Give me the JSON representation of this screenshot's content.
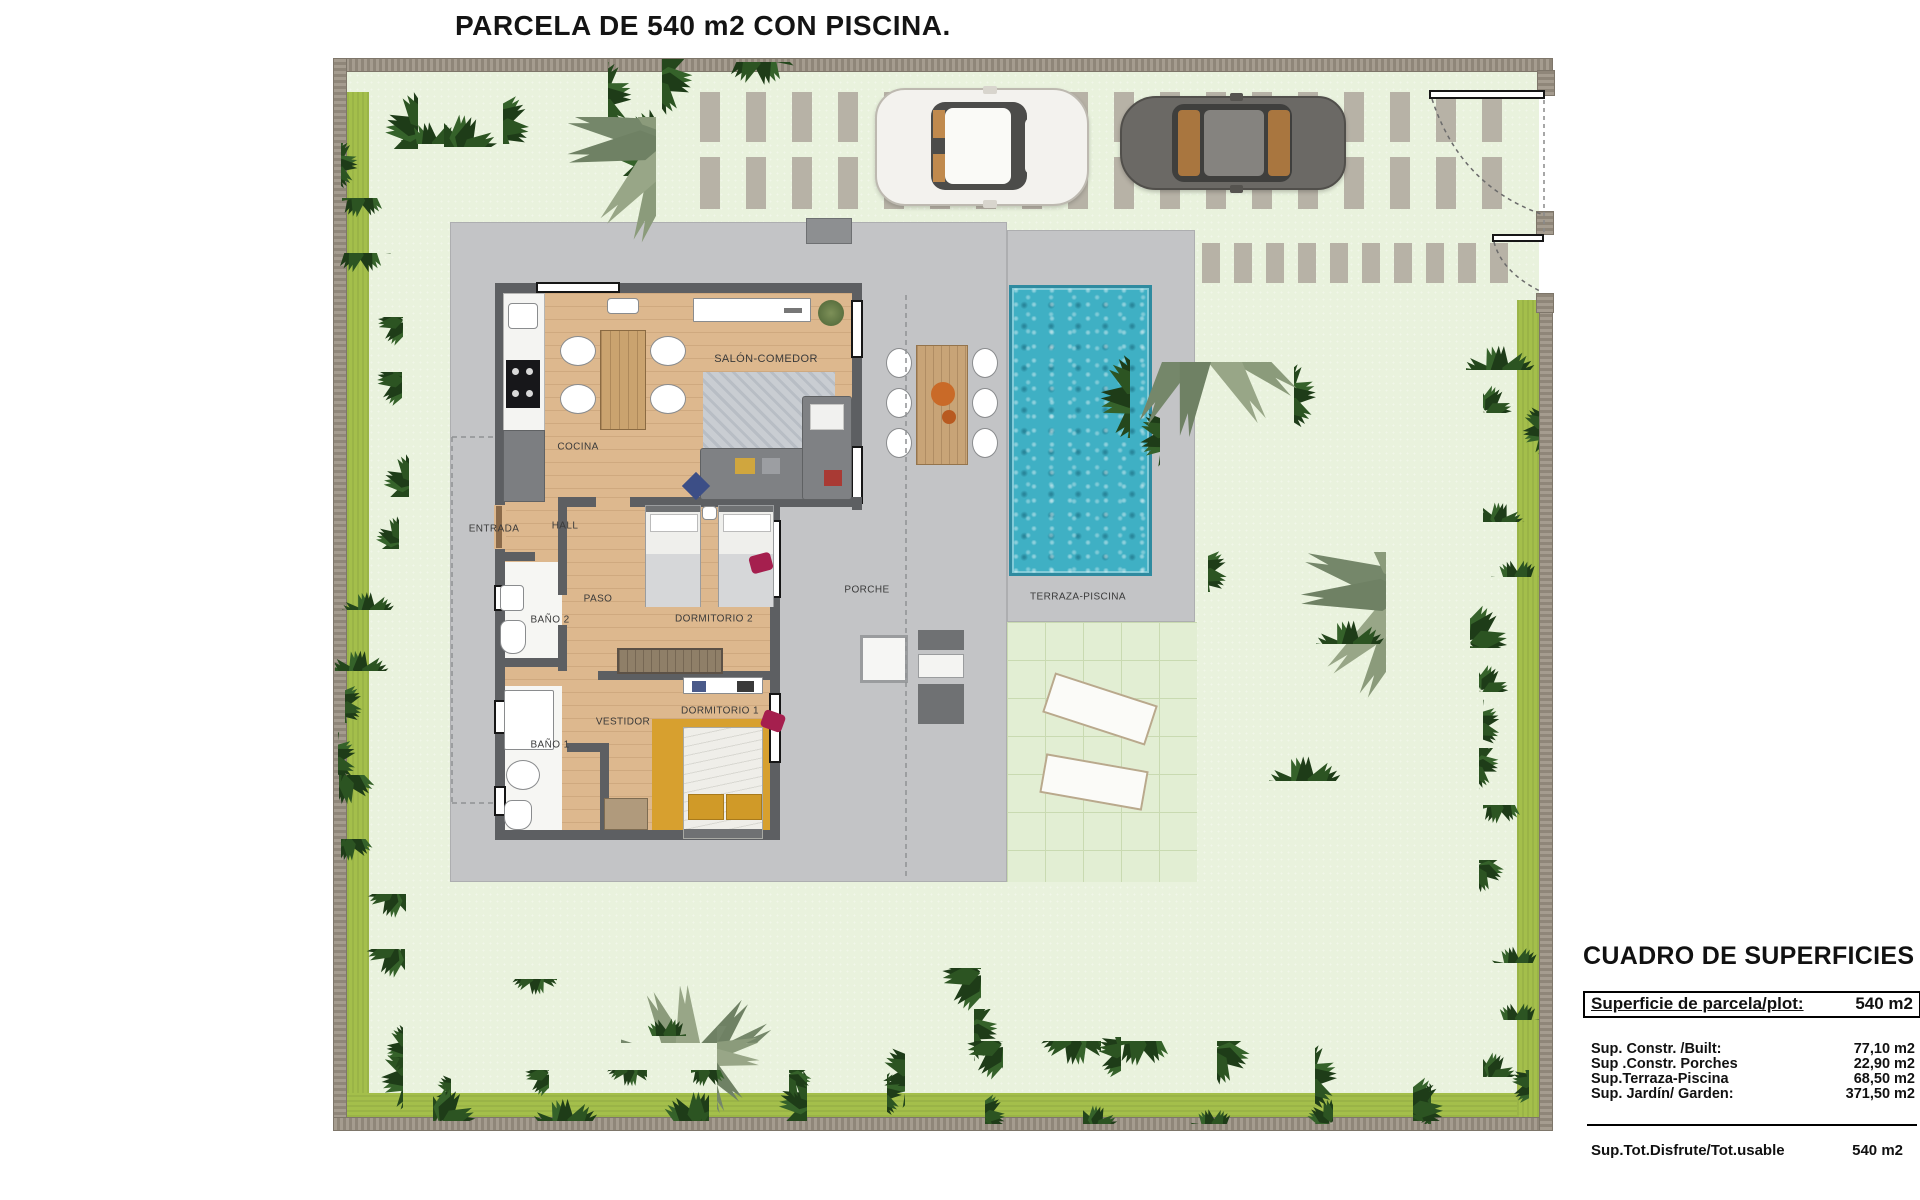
{
  "title": "PARCELA DE 540 m2 CON PISCINA.",
  "floor_plan": {
    "room_labels": [
      {
        "id": "salon-comedor",
        "label": "SALÓN-COMEDOR"
      },
      {
        "id": "cocina",
        "label": "COCINA"
      },
      {
        "id": "entrada",
        "label": "ENTRADA"
      },
      {
        "id": "hall",
        "label": "HALL"
      },
      {
        "id": "paso",
        "label": "PASO"
      },
      {
        "id": "bano-2",
        "label": "BAÑO 2"
      },
      {
        "id": "dormitorio-2",
        "label": "DORMITORIO 2"
      },
      {
        "id": "vestidor",
        "label": "VESTIDOR"
      },
      {
        "id": "bano-1",
        "label": "BAÑO 1"
      },
      {
        "id": "dormitorio-1",
        "label": "DORMITORIO 1"
      },
      {
        "id": "porche",
        "label": "PORCHE"
      },
      {
        "id": "terraza-piscina",
        "label": "TERRAZA-PISCINA"
      }
    ]
  },
  "summary_table": {
    "heading": "CUADRO DE SUPERFICIES",
    "plot_row": {
      "label": "Superficie de parcela/plot:",
      "value": "540 m2"
    },
    "rows": [
      {
        "label": "Sup. Constr. /Built:",
        "value": "77,10 m2"
      },
      {
        "label": "Sup .Constr. Porches",
        "value": "22,90 m2"
      },
      {
        "label": "Sup.Terraza-Piscina",
        "value": "68,50 m2"
      },
      {
        "label": "Sup. Jardín/ Garden:",
        "value": "371,50 m2"
      }
    ],
    "total_row": {
      "label": "Sup.Tot.Disfrute/Tot.usable",
      "value": "540 m2"
    }
  },
  "colors": {
    "pool_water": "#3fb0c4",
    "garden_green": "#e9f2dd",
    "hardscape_grey": "#c3c4c6",
    "wall_grey": "#9a9184",
    "lime_green": "#a4bf4b",
    "wood_floor": "#ddb88e",
    "accent_ochre": "#d7a02f",
    "shrub_green": "#2c5422",
    "palm_sage": "#8b9b7b"
  }
}
